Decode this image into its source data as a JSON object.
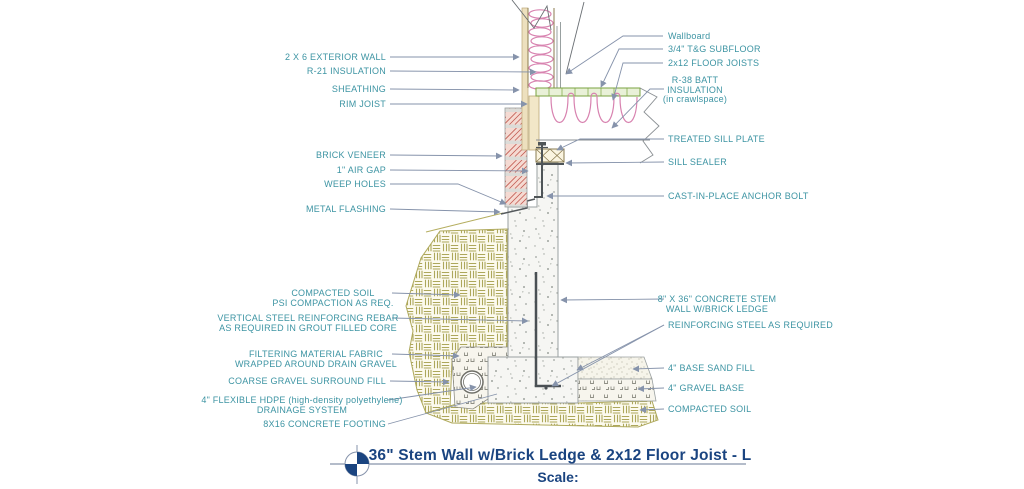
{
  "drawing_title_block": {
    "title": "36\" Stem Wall w/Brick Ledge & 2x12 Floor Joist - L",
    "scale_label": "Scale:"
  },
  "labels": {
    "left": {
      "exterior_wall": "2 X 6 EXTERIOR WALL",
      "r21_insulation": "R-21 INSULATION",
      "sheathing": "SHEATHING",
      "rim_joist": "RIM JOIST",
      "brick_veneer": "BRICK VENEER",
      "air_gap": "1\" AIR GAP",
      "weep_holes": "WEEP HOLES",
      "metal_flashing": "METAL FLASHING",
      "compacted_soil_line1": "COMPACTED SOIL",
      "compacted_soil_line2": "PSI COMPACTION AS REQ.",
      "vertical_rebar_line1": "VERTICAL STEEL REINFORCING REBAR",
      "vertical_rebar_line2": "AS REQUIRED IN GROUT FILLED CORE",
      "filter_fabric_line1": "FILTERING MATERIAL FABRIC",
      "filter_fabric_line2": "WRAPPED AROUND DRAIN GRAVEL",
      "coarse_gravel": "COARSE GRAVEL SURROUND FILL",
      "hdpe_line1": "4\" FLEXIBLE HDPE (high-density polyethylene)",
      "hdpe_line2": "DRAINAGE SYSTEM",
      "footing": "8X16 CONCRETE FOOTING"
    },
    "right": {
      "wallboard": "Wallboard",
      "subfloor": "3/4\" T&G SUBFLOOR",
      "floor_joists": "2x12 FLOOR JOISTS",
      "batt_line1": "R-38 BATT",
      "batt_line2": "INSULATION",
      "batt_line3": "(in crawlspace)",
      "sill_plate": "TREATED SILL PLATE",
      "sill_sealer": "SILL SEALER",
      "anchor_bolt": "CAST-IN-PLACE ANCHOR BOLT",
      "stem_wall_line1": "8\" X 36\" CONCRETE STEM",
      "stem_wall_line2": "WALL W/BRICK LEDGE",
      "reinforcing_steel": "REINFORCING STEEL AS REQUIRED",
      "sand_fill": "4\" BASE SAND FILL",
      "gravel_base": "4\" GRAVEL BASE",
      "compacted_soil": "COMPACTED SOIL"
    }
  },
  "colors": {
    "label_text": "#3D94A3",
    "leader_line": "#8693AB",
    "title_text": "#1A4480",
    "brick_hatch": "#C25A50",
    "insulation_pink": "#D883B0",
    "subfloor_green": "#7AA341",
    "soil_olive": "#ADA75B",
    "concrete_speckle": "#9FA49F",
    "wood_tan": "#EDE0BE"
  }
}
